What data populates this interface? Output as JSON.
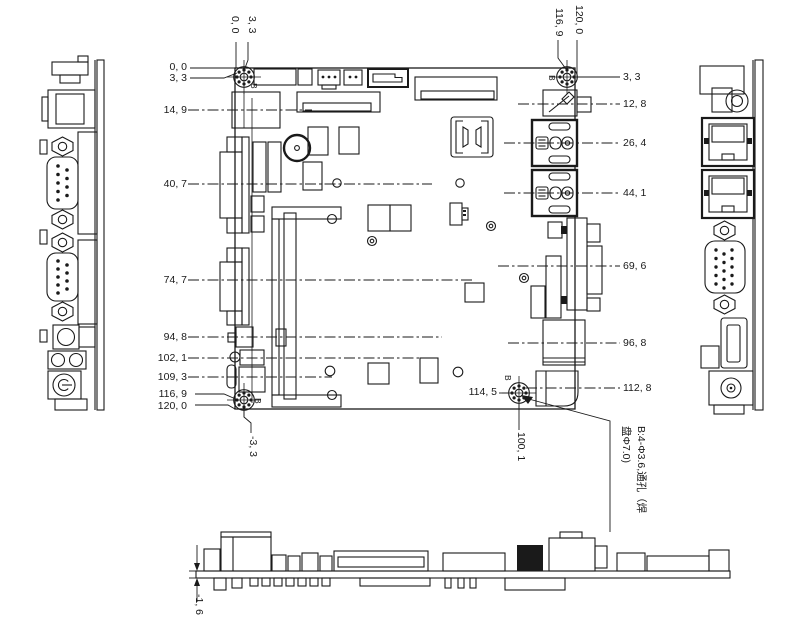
{
  "hole_label": "B",
  "note_line1": "B:4-Φ3.6,通孔（焊",
  "note_line2": "盘Φ7.0)",
  "dims_left": [
    "0, 0",
    "3, 3",
    "14, 9",
    "40, 7",
    "74, 7",
    "94, 8",
    "102, 1",
    "109, 3",
    "116, 9",
    "120, 0"
  ],
  "dims_right": [
    "3, 3",
    "12, 8",
    "26, 4",
    "44, 1",
    "69, 6",
    "96, 8",
    "112, 8"
  ],
  "dims_top_left": [
    "0, 0",
    "3, 3"
  ],
  "dims_top_right": [
    "116, 9",
    "120, 0"
  ],
  "dim_bottom_left": "-3, 3",
  "dim_bottom_x": "100, 1",
  "dim_bottom_y": "114, 5",
  "dim_board_thickness": "-1, 6"
}
